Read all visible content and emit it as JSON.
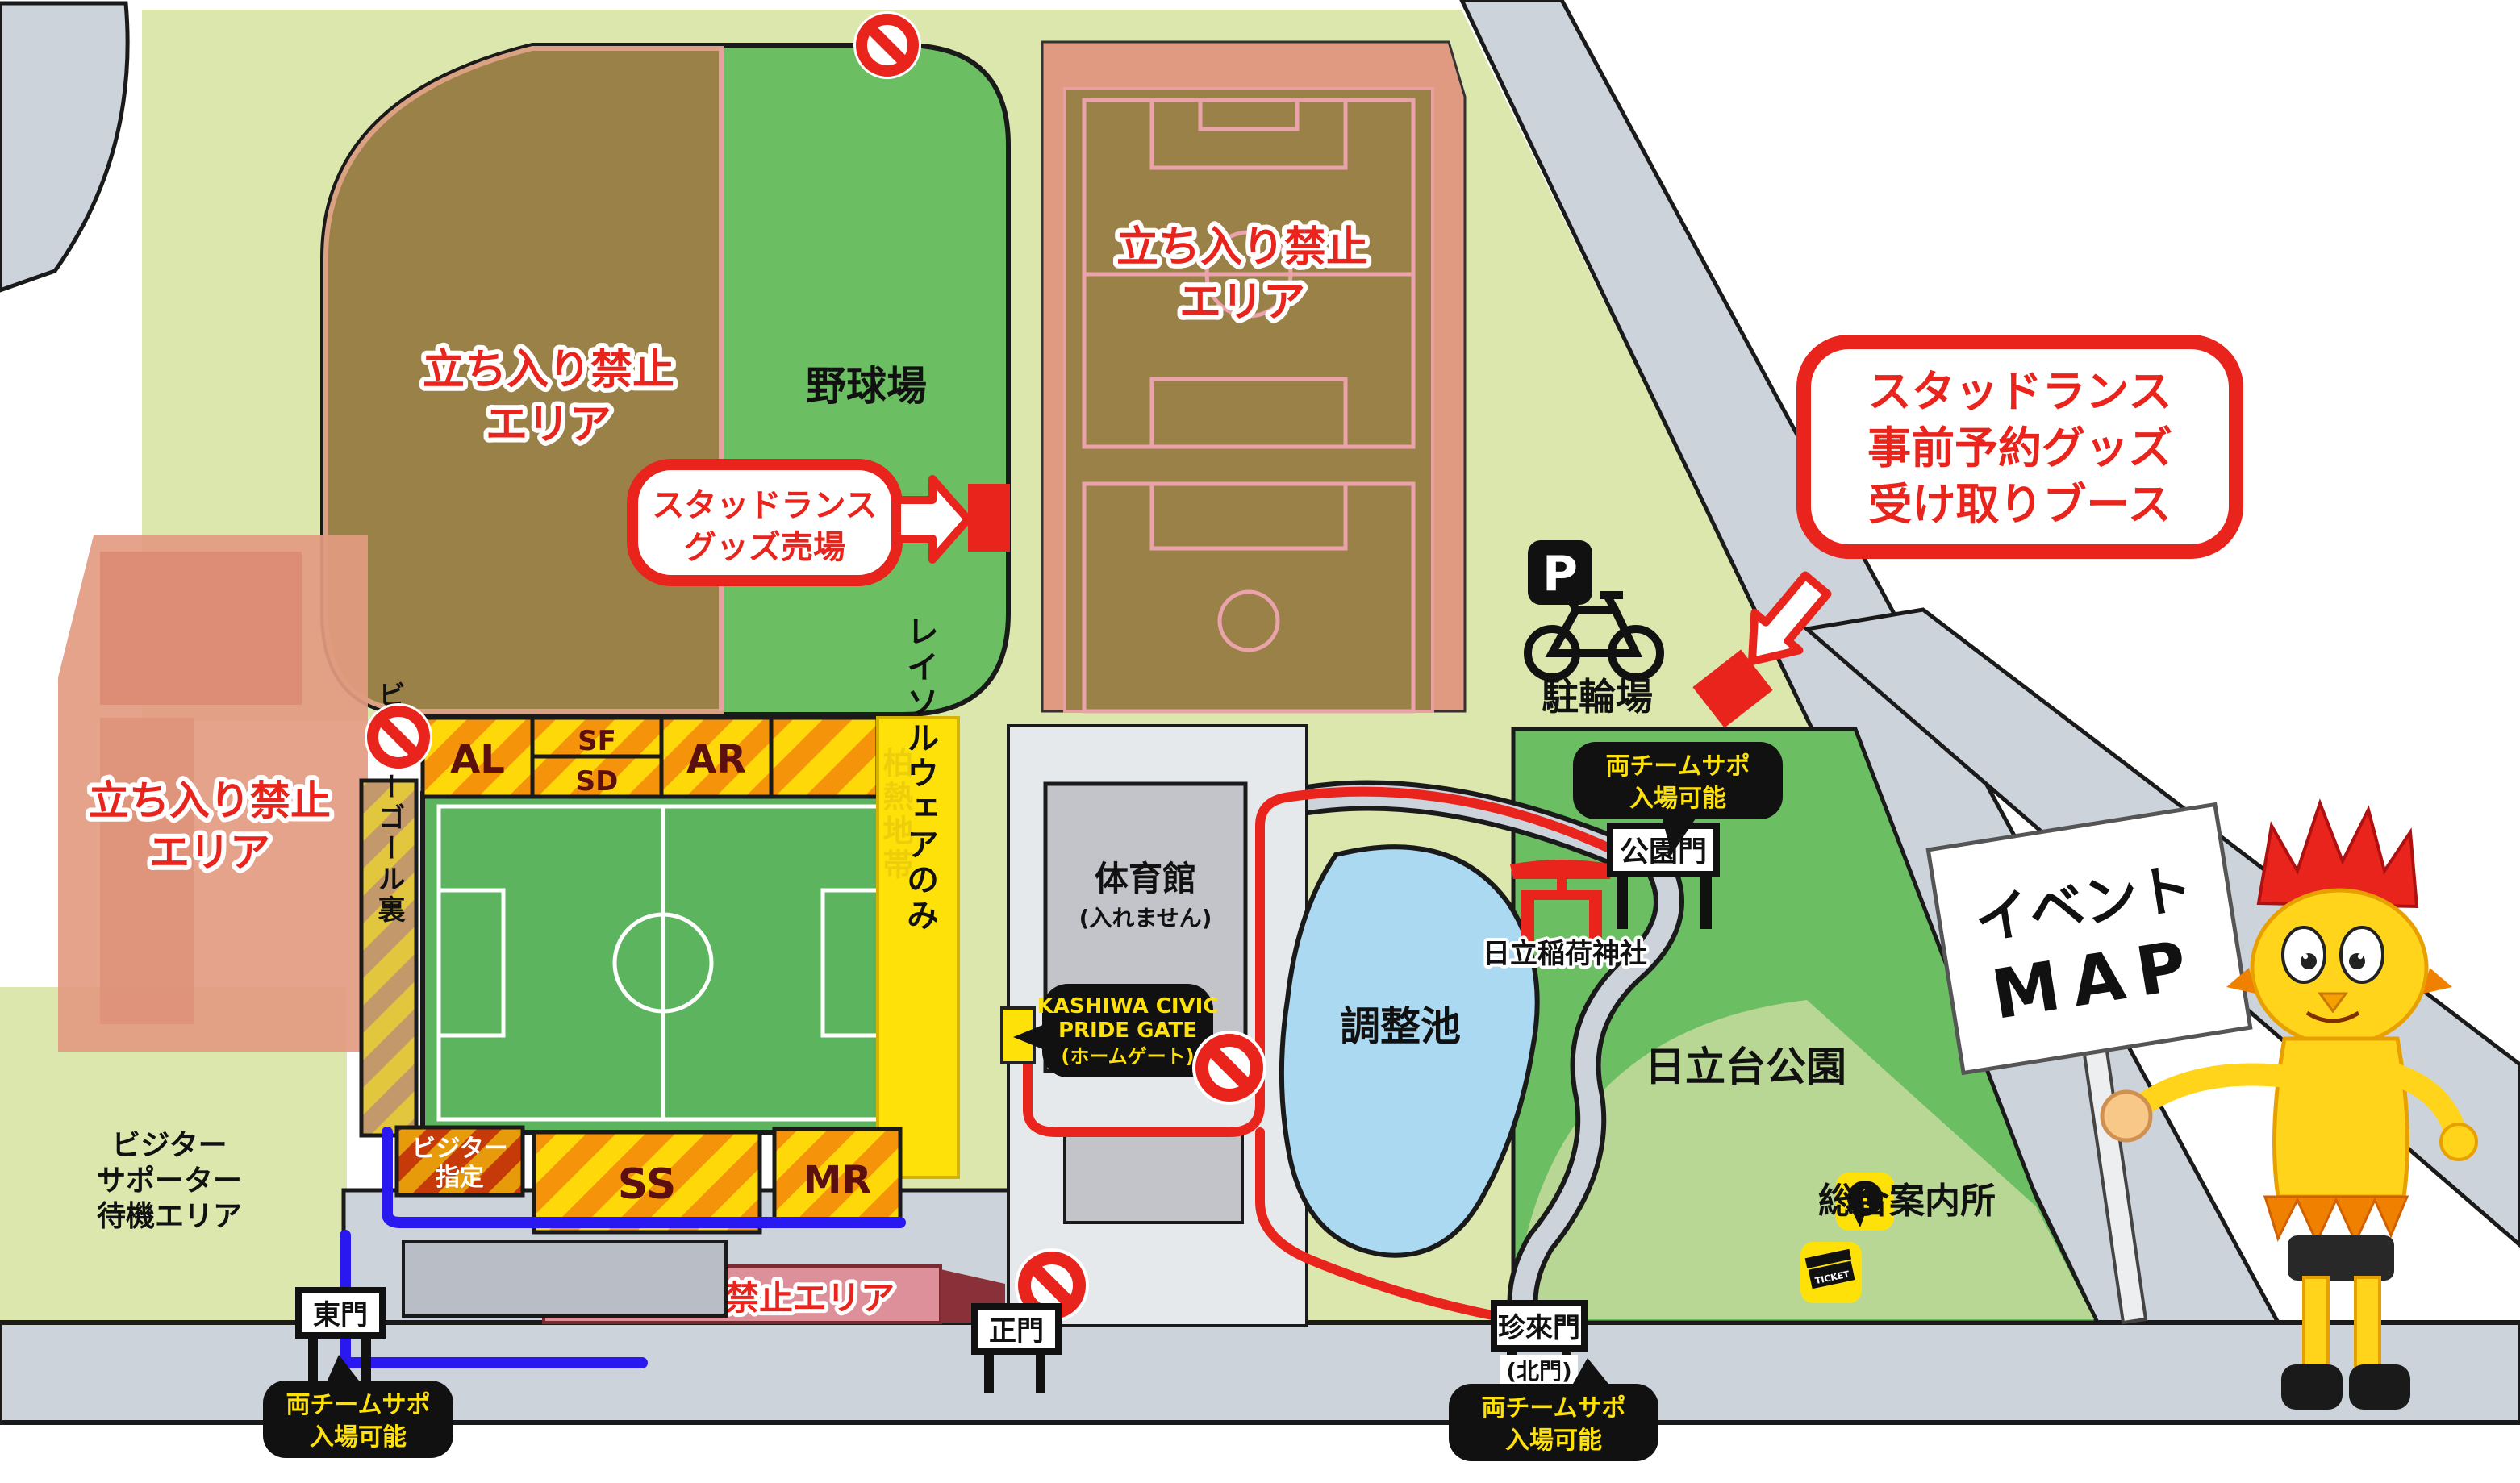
{
  "areas": {
    "no_entry": {
      "lines": [
        "立ち入り禁止",
        "エリア"
      ],
      "single_line": "立ち入り禁止エリア"
    },
    "baseball_field": "野球場",
    "visitor_waiting": {
      "lines": [
        "ビジター",
        "サポーター",
        "待機エリア"
      ]
    },
    "gymnasium": {
      "lines": [
        "体育館",
        "(入れません)"
      ]
    },
    "pond": "調整池",
    "shrine": "日立稲荷神社",
    "park": "日立台公園",
    "watermark": "柏熱地帯"
  },
  "stands": {
    "al": "AL",
    "sf": "SF",
    "sd": "SD",
    "ar": "AR",
    "ss": "SS",
    "mr": "MR",
    "visitor_goal_back": "ビジターゴール裏",
    "visitor_reserved": {
      "lines": [
        "ビジター",
        "指定"
      ]
    },
    "reysol_wear_only": "レイソルウェアのみ"
  },
  "bubbles": {
    "goods_shop": {
      "lines": [
        "スタッドランス",
        "グッズ売場"
      ]
    },
    "preorder_booth": {
      "lines": [
        "スタッドランス",
        "事前予約グッズ",
        "受け取りブース"
      ]
    },
    "pride_gate": {
      "lines": [
        "KASHIWA CIVIC",
        "PRIDE GATE",
        "(ホームゲート)"
      ]
    },
    "both_teams": {
      "lines": [
        "両チームサポ",
        "入場可能"
      ]
    }
  },
  "gates": {
    "park_gate": "公園門",
    "east_gate": "東門",
    "main_gate": "正門",
    "chinrai_gate": "珍來門",
    "chinrai_gate_alias": "(北門)"
  },
  "facilities": {
    "bicycle_parking": "駐輪場",
    "parking_letter": "P",
    "info_center": "総合案内所",
    "ticket_label": "TICKET",
    "event_sign": {
      "lines": [
        "イベント",
        "MAP"
      ]
    }
  },
  "colors": {
    "accent_red": "#e8241c",
    "route_blue": "#2a18f0",
    "bubble_black": "#111111",
    "bubble_yellow_text": "#ffe10a",
    "field_green": "#6cbe63",
    "no_entry_brown": "#9a8148",
    "no_entry_salmon": "#e29b80",
    "no_entry_pink": "#dd8f9a",
    "park_light_green": "#dce7ae",
    "road_grey": "#ccd3db",
    "pond_blue": "#abd9f2",
    "stand_yellow": "#ffd80a",
    "stand_orange": "#f5930a"
  }
}
